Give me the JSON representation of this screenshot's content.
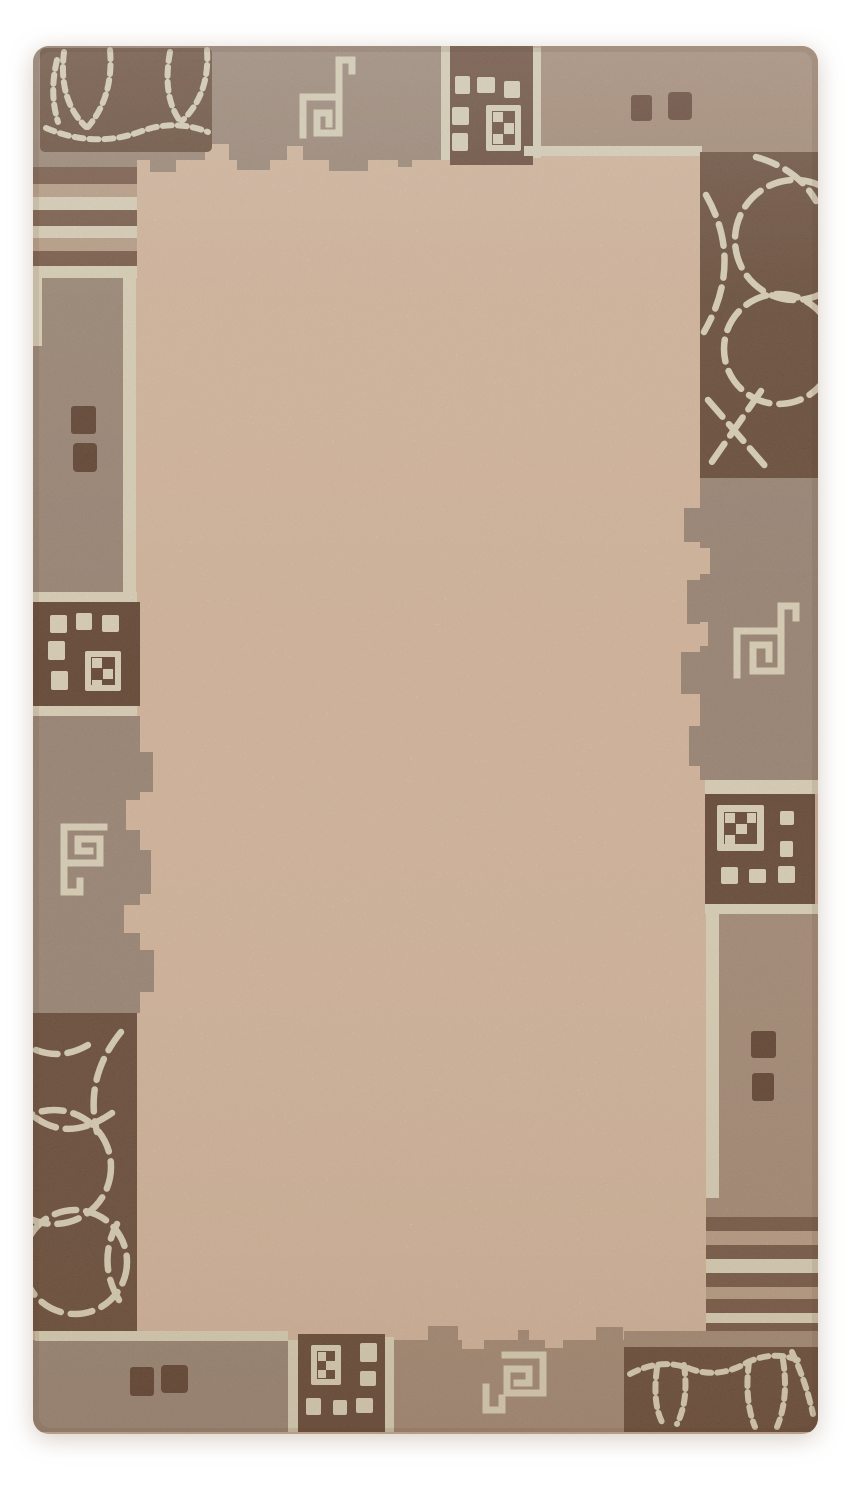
{
  "page": {
    "background": "#ffffff"
  },
  "rug": {
    "colors": {
      "field": "#e9c5a7",
      "taupe_gray": "#a78e7a",
      "taupe_warm": "#b2937a",
      "brown_dark": "#6b4832",
      "brown_mid": "#6d4b34",
      "accent_square": "#64412c",
      "cream": "#f0e4c6",
      "stripe_brown": "#7d5942",
      "stripe_tan": "#c9a98b"
    }
  }
}
